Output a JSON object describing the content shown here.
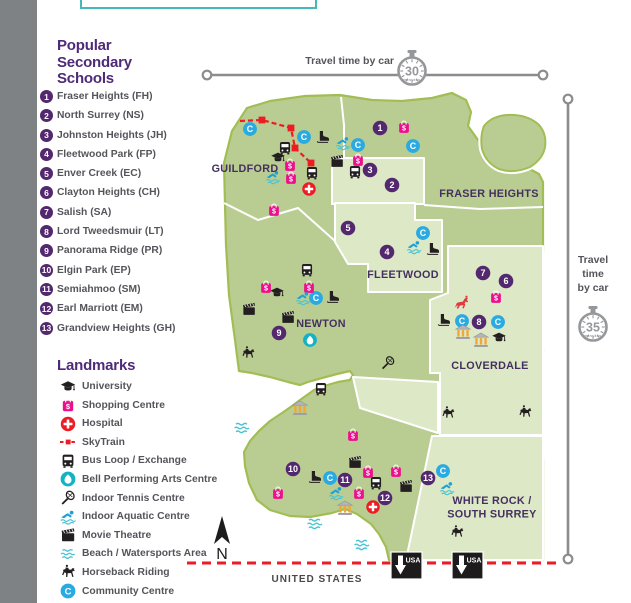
{
  "schools": {
    "title_lines": [
      "Popular",
      "Secondary",
      "Schools"
    ],
    "items": [
      {
        "n": "1",
        "name": "Fraser Heights (FH)"
      },
      {
        "n": "2",
        "name": "North Surrey (NS)"
      },
      {
        "n": "3",
        "name": "Johnston Heights (JH)"
      },
      {
        "n": "4",
        "name": "Fleetwood Park (FP)"
      },
      {
        "n": "5",
        "name": "Enver Creek (EC)"
      },
      {
        "n": "6",
        "name": "Clayton Heights (CH)"
      },
      {
        "n": "7",
        "name": "Salish (SA)"
      },
      {
        "n": "8",
        "name": "Lord Tweedsmuir (LT)"
      },
      {
        "n": "9",
        "name": "Panorama Ridge (PR)"
      },
      {
        "n": "10",
        "name": "Elgin Park (EP)"
      },
      {
        "n": "11",
        "name": "Semiahmoo (SM)"
      },
      {
        "n": "12",
        "name": "Earl Marriott (EM)"
      },
      {
        "n": "13",
        "name": "Grandview Heights (GH)"
      }
    ]
  },
  "landmarks": {
    "title": "Landmarks",
    "items": [
      {
        "icon": "university",
        "label": "University"
      },
      {
        "icon": "shopping",
        "label": "Shopping Centre"
      },
      {
        "icon": "hospital",
        "label": "Hospital"
      },
      {
        "icon": "skytrain",
        "label": "SkyTrain"
      },
      {
        "icon": "bus",
        "label": "Bus Loop / Exchange"
      },
      {
        "icon": "bell",
        "label": "Bell Performing Arts Centre"
      },
      {
        "icon": "tennis",
        "label": "Indoor Tennis Centre"
      },
      {
        "icon": "swim",
        "label": "Indoor Aquatic Centre"
      },
      {
        "icon": "movie",
        "label": "Movie Theatre"
      },
      {
        "icon": "waves",
        "label": "Beach / Watersports Area"
      },
      {
        "icon": "horse",
        "label": "Horseback Riding"
      },
      {
        "icon": "community",
        "label": "Community Centre"
      }
    ]
  },
  "travel": {
    "top_label": "Travel time by car",
    "top_minutes": "30",
    "side_label_lines": [
      "Travel",
      "time",
      "by car"
    ],
    "side_minutes": "35",
    "minutes_word": "minutes"
  },
  "map": {
    "regions": [
      {
        "lines": [
          "GUILDFORD"
        ],
        "x": 245,
        "y": 172
      },
      {
        "lines": [
          "FRASER HEIGHTS"
        ],
        "x": 489,
        "y": 197
      },
      {
        "lines": [
          "FLEETWOOD"
        ],
        "x": 403,
        "y": 278
      },
      {
        "lines": [
          "NEWTON"
        ],
        "x": 321,
        "y": 327
      },
      {
        "lines": [
          "CLOVERDALE"
        ],
        "x": 490,
        "y": 369
      },
      {
        "lines": [
          "WHITE ROCK /",
          "SOUTH SURREY"
        ],
        "x": 492,
        "y": 504
      }
    ],
    "markers": [
      {
        "n": "1",
        "x": 380,
        "y": 128
      },
      {
        "n": "2",
        "x": 392,
        "y": 185
      },
      {
        "n": "3",
        "x": 370,
        "y": 170
      },
      {
        "n": "4",
        "x": 387,
        "y": 252
      },
      {
        "n": "5",
        "x": 348,
        "y": 228
      },
      {
        "n": "6",
        "x": 506,
        "y": 281
      },
      {
        "n": "7",
        "x": 483,
        "y": 273
      },
      {
        "n": "8",
        "x": 479,
        "y": 322
      },
      {
        "n": "9",
        "x": 279,
        "y": 333
      },
      {
        "n": "10",
        "x": 293,
        "y": 469
      },
      {
        "n": "11",
        "x": 345,
        "y": 480
      },
      {
        "n": "12",
        "x": 385,
        "y": 498
      },
      {
        "n": "13",
        "x": 428,
        "y": 478
      }
    ],
    "icons": [
      [
        "community",
        250,
        129
      ],
      [
        "community",
        304,
        137
      ],
      [
        "community",
        358,
        145
      ],
      [
        "community",
        413,
        146
      ],
      [
        "community",
        423,
        233
      ],
      [
        "community",
        316,
        298
      ],
      [
        "community",
        462,
        321
      ],
      [
        "community",
        498,
        322
      ],
      [
        "community",
        330,
        478
      ],
      [
        "community",
        443,
        471
      ],
      [
        "skate",
        323,
        137
      ],
      [
        "skate",
        433,
        249
      ],
      [
        "skate",
        333,
        297
      ],
      [
        "skate",
        444,
        320
      ],
      [
        "skate",
        315,
        477
      ],
      [
        "bus",
        285,
        148
      ],
      [
        "bus",
        312,
        173
      ],
      [
        "bus",
        355,
        172
      ],
      [
        "bus",
        307,
        270
      ],
      [
        "bus",
        321,
        389
      ],
      [
        "bus",
        376,
        483
      ],
      [
        "university",
        278,
        158
      ],
      [
        "university",
        277,
        293
      ],
      [
        "university",
        499,
        338
      ],
      [
        "shopping",
        290,
        165
      ],
      [
        "shopping",
        291,
        178
      ],
      [
        "shopping",
        274,
        210
      ],
      [
        "shopping",
        404,
        127
      ],
      [
        "shopping",
        358,
        160
      ],
      [
        "shopping",
        266,
        287
      ],
      [
        "shopping",
        309,
        287
      ],
      [
        "shopping",
        496,
        297
      ],
      [
        "shopping",
        353,
        435
      ],
      [
        "shopping",
        368,
        472
      ],
      [
        "shopping",
        396,
        471
      ],
      [
        "shopping",
        359,
        493
      ],
      [
        "shopping",
        278,
        493
      ],
      [
        "swim",
        273,
        177
      ],
      [
        "swim",
        343,
        143
      ],
      [
        "swim",
        414,
        247
      ],
      [
        "swim",
        303,
        298
      ],
      [
        "swim",
        336,
        493
      ],
      [
        "swim",
        447,
        488
      ],
      [
        "hospital",
        309,
        189
      ],
      [
        "hospital",
        373,
        507
      ],
      [
        "movie",
        337,
        161
      ],
      [
        "movie",
        249,
        309
      ],
      [
        "movie",
        288,
        317
      ],
      [
        "movie",
        355,
        462
      ],
      [
        "movie",
        406,
        486
      ],
      [
        "bell",
        310,
        340
      ],
      [
        "horse",
        248,
        353
      ],
      [
        "horse",
        448,
        413
      ],
      [
        "horse",
        525,
        412
      ],
      [
        "horse",
        457,
        532
      ],
      [
        "rodeo",
        462,
        303,
        18
      ],
      [
        "heritage",
        463,
        332,
        17
      ],
      [
        "heritage",
        481,
        340,
        17
      ],
      [
        "heritage",
        300,
        408,
        17
      ],
      [
        "heritage",
        345,
        508,
        17
      ],
      [
        "tennis",
        388,
        363
      ],
      [
        "waves",
        242,
        428,
        17
      ],
      [
        "waves",
        315,
        524,
        17
      ],
      [
        "waves",
        362,
        545,
        17
      ]
    ],
    "skytrain": {
      "path": "240,121 262,120 291,128 295,148 311,163",
      "stops": [
        [
          262,
          120
        ],
        [
          291,
          128
        ],
        [
          295,
          148
        ],
        [
          311,
          163
        ]
      ]
    },
    "compass_label": "N",
    "border_label": "UNITED STATES",
    "usa_label": "USA",
    "usa_signs": [
      {
        "x": 391,
        "y": 552
      },
      {
        "x": 452,
        "y": 552
      }
    ]
  },
  "colors": {
    "purple": "#4e2a78",
    "badge": "#53286e",
    "region_label": "#44305f",
    "land": "#b9cd92",
    "land_light": "#dde8c6",
    "outline": "#a2bd54",
    "pink": "#ec108c",
    "red": "#ed1c24",
    "blue": "#29abe2",
    "teal": "#14b3c4",
    "line_gray": "#8a8c8e",
    "watch_gray": "#96979a",
    "text_gray": "#54555a"
  }
}
